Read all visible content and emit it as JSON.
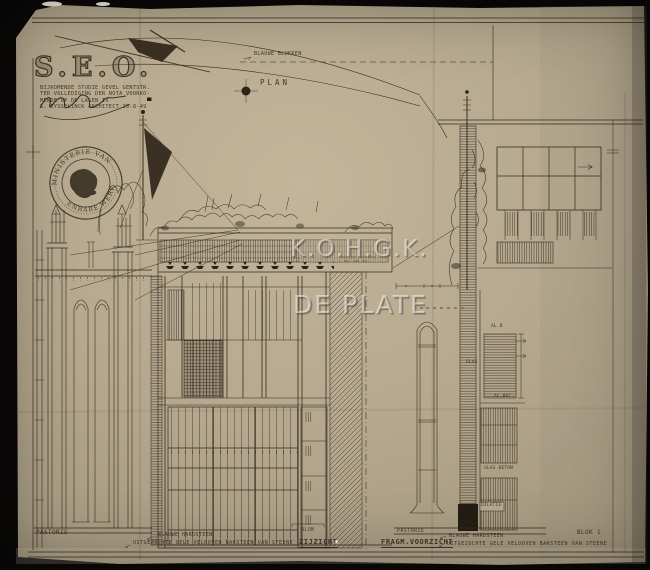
{
  "document": {
    "title": "S.E.O.",
    "notes": {
      "line1": "BIJKOMENDE STUDIE GEVEL GENTSTR.",
      "line2": "TER VOLLEDIGING der NOTA VOORKO-",
      "line3": "MENDE OP DE LAGEN IV",
      "line4": "G. EYSSELINCK ARCHITECT 20-8-49"
    },
    "stamp": {
      "top_text": "MINISTERIE VAN",
      "bottom_text": "OPENBARE WERKEN"
    },
    "watermark": {
      "line1": "K.O.H.G.K.",
      "line2": "DE PLATE"
    },
    "plan": {
      "label": "PLAN",
      "annotation": "BLAUWE BLOKKEN"
    },
    "labels": {
      "pastorie_left": "PASTORIE",
      "material_hardsteen_center": "BLAUWE HARDSTEEN",
      "material_baksteen_center": "UITGEZOCHTE GELE VELDOVEN BAKSTEEN VAN STEENE",
      "blok_center": "BLOK",
      "zijzicht": "ZIJZICHT",
      "pastorie_right": "PASTORIE",
      "fragm_voorzicht": "FRAGM.VOORZICHT",
      "material_hardsteen_right": "BLAUWE HARDSTEEN",
      "material_baksteen_right": "UITGEZOCHTE GELE VELDOVEN BAKSTEEN VAN STEENE",
      "blok1": "BLOK 1",
      "dilatie": "DILATIE",
      "al_b": "AL.B",
      "glas": "GLAS",
      "al_bat": "AL.BAT.",
      "glas_beton": "GLAS BETON"
    },
    "colors": {
      "paper": "#b5a88e",
      "ink": "#372d21",
      "photo_background": "#0a0908",
      "watermark": "#faf8f2"
    }
  }
}
